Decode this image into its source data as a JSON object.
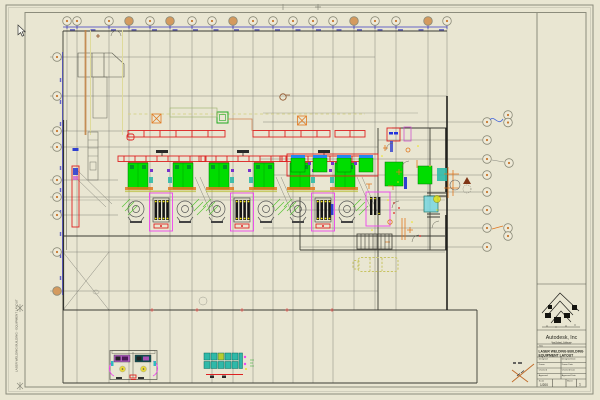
{
  "title_block": {
    "company": "Autodesk, Inc",
    "company_subtitle": "San Rafael, California",
    "title_label": "Title",
    "title_line1": "LASER WELDING BUILDING",
    "title_line2": "EQUIPMENT LAYOUT",
    "fields": [
      {
        "label": "Designed",
        "date_label": "Designed Date"
      },
      {
        "label": "Drawn",
        "date_label": "Drawn Date"
      },
      {
        "label": "Checked",
        "date_label": "Checked Date"
      },
      {
        "label": "Approved",
        "date_label": "Approved Date"
      }
    ],
    "scale_label": "Scale",
    "scale_value": "1/200",
    "sheet_label": "Sheet",
    "sheet_value": "1"
  },
  "margin_stamp": "LASER WELDING BUILDING - EQUIPMENT LAYOUT",
  "colors": {
    "paper": "#e9e6d2",
    "dimension_blue": "#3a3ac0",
    "crane_red": "#dd2222",
    "machine_green": "#00dd00",
    "fixture_magenta": "#ee44ee",
    "equipment_cyan": "#2fb9a9",
    "accent_orange": "#e07820",
    "highlight_yellow": "#efe400",
    "bubble_tan": "#d49a5e"
  }
}
